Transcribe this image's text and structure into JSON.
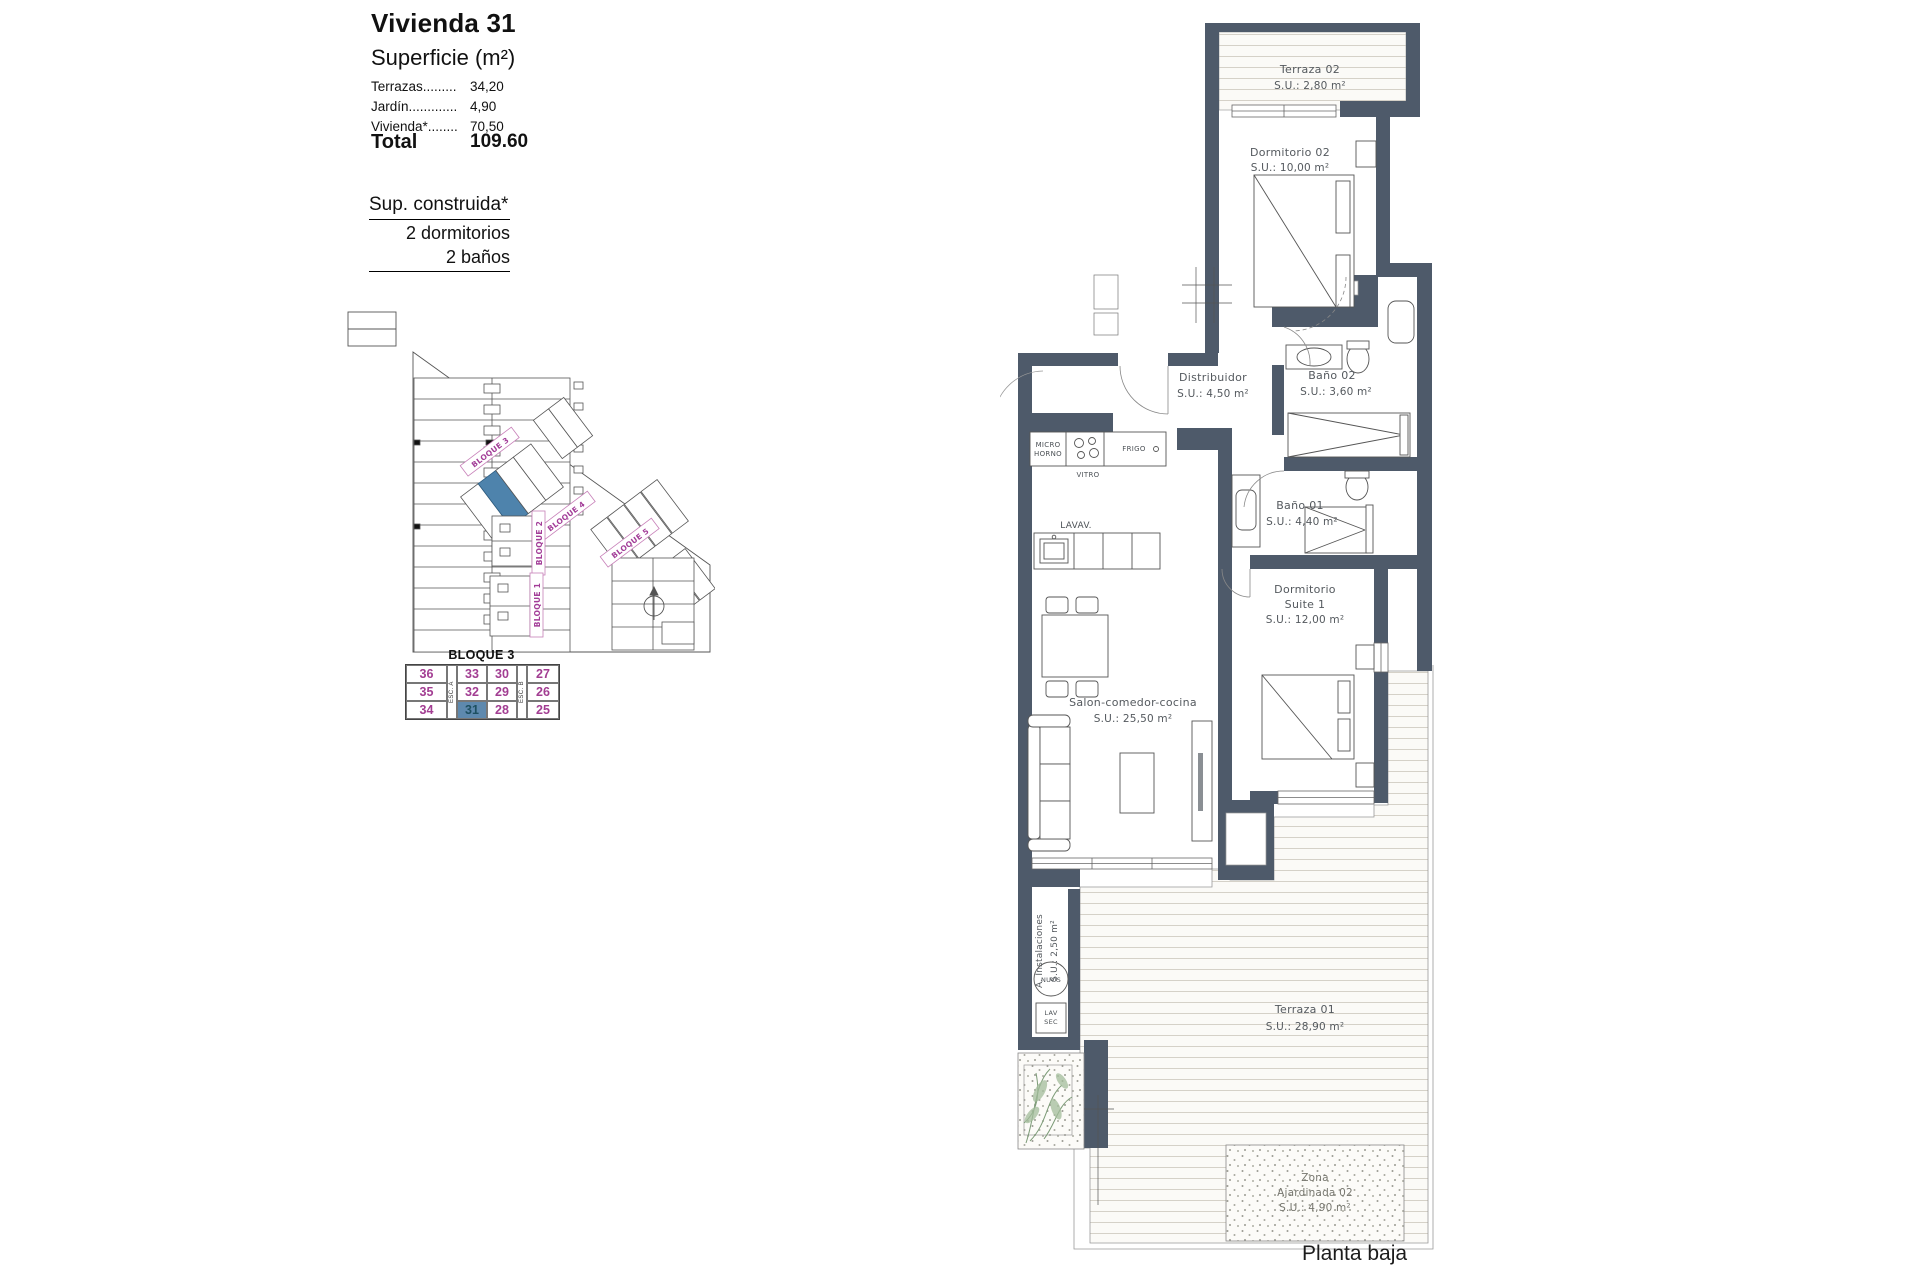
{
  "info_panel": {
    "title": "Vivienda 31",
    "subtitle": "Superficie (m²)",
    "rows": [
      {
        "label": "Terrazas.........",
        "value": "34,20"
      },
      {
        "label": "Jardín.............",
        "value": "4,90"
      },
      {
        "label": "Vivienda*........",
        "value": "70,50"
      }
    ],
    "total_label": "Total",
    "total_value": "109.60",
    "construida_title": "Sup. construida*",
    "construida_line1": "2 dormitorios",
    "construida_line2": "2 baños"
  },
  "site_plan": {
    "bloque1": "BLOQUE 1",
    "bloque2": "BLOQUE 2",
    "bloque3": "BLOQUE 3",
    "bloque4": "BLOQUE 4",
    "bloque5": "BLOQUE 5",
    "highlight_color": "#4e83ac"
  },
  "bloque_table": {
    "title": "BLOQUE 3",
    "esc_a": "ESC. A",
    "esc_b": "ESC. B",
    "cells": [
      [
        "36",
        "33",
        "30",
        "27"
      ],
      [
        "35",
        "32",
        "29",
        "26"
      ],
      [
        "34",
        "31",
        "28",
        "25"
      ]
    ],
    "highlighted_unit": "31"
  },
  "rooms": {
    "terraza02": {
      "name": "Terraza 02",
      "su": "S.U.: 2,80 m²"
    },
    "dormitorio02": {
      "name": "Dormitorio 02",
      "su": "S.U.: 10,00 m²"
    },
    "distribuidor": {
      "name": "Distribuidor",
      "su": "S.U.: 4,50 m²"
    },
    "bano02": {
      "name": "Baño 02",
      "su": "S.U.: 3,60 m²"
    },
    "bano01": {
      "name": "Baño 01",
      "su": "S.U.: 4,40 m²"
    },
    "suite": {
      "line1": "Dormitorio",
      "line2": "Suite 1",
      "su": "S.U.: 12,00 m²"
    },
    "salon": {
      "name": "Salon-comedor-cocina",
      "su": "S.U.: 25,50 m²"
    },
    "instalaciones": {
      "name": "A. Instalaciones",
      "su": "S.U.: 2,50 m²"
    },
    "terraza01": {
      "name": "Terraza 01",
      "su": "S.U.: 28,90 m²"
    },
    "zona": {
      "line1": "Zona",
      "line2": "Ajardinada 02",
      "su": "S.U.: 4,90 m²"
    }
  },
  "appliances": {
    "micro1": "MICRO",
    "micro2": "HORNO",
    "vitro": "VITRO",
    "frigo": "FRIGO",
    "lavav": "LAVAV.",
    "nuos": "NUOS",
    "lav": "LAV",
    "sec": "SEC"
  },
  "footer": "Planta baja",
  "colors": {
    "wall": "#4e5a6a",
    "magenta": "#a23d92",
    "highlight_blue": "#4e83ac"
  }
}
